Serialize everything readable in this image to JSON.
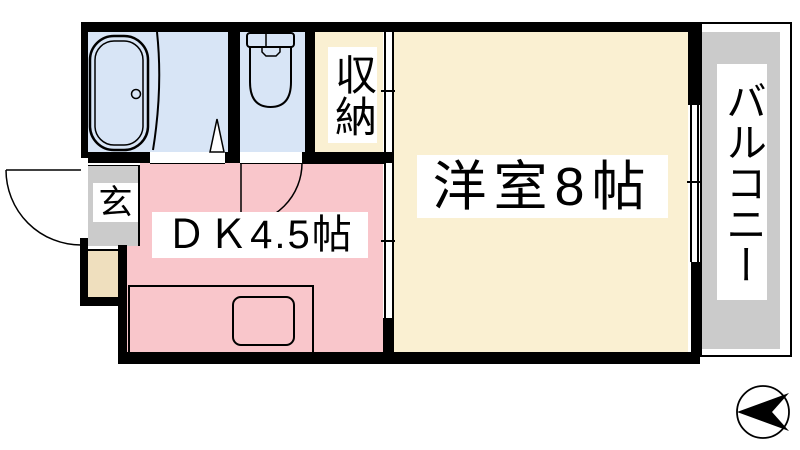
{
  "title": "apartment floor plan",
  "rooms": {
    "dk": {
      "label": "ＤＫ4.5帖",
      "color": "#f9c6cb"
    },
    "western_room": {
      "label": "洋室8帖",
      "color": "#faf0d2"
    },
    "closet": {
      "label": "収納",
      "color": "#faf0d2"
    },
    "entrance": {
      "label": "玄",
      "color": "#cbcbcb"
    },
    "balcony": {
      "label": "バルコニー",
      "color": "#cbcbcb"
    },
    "bathroom": {
      "color": "#d8e5f6"
    },
    "toilet": {
      "color": "#d8e5f6"
    },
    "alcove": {
      "color": "#efdfbe"
    }
  },
  "compass": {
    "arrow_direction": "left"
  },
  "wall_color": "#000000",
  "background_color": "#ffffff"
}
